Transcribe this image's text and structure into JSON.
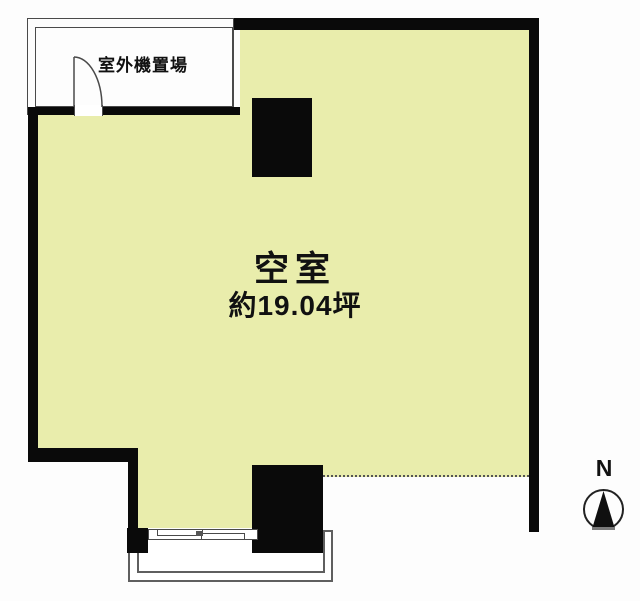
{
  "plan": {
    "outdoor_unit_label": "室外機置場",
    "room": {
      "status_label": "空室",
      "area_label": "約19.04坪"
    },
    "compass": {
      "north_label": "N"
    }
  },
  "colors": {
    "room_fill": "#e9edac",
    "wall": "#0a0a0a",
    "thin_line": "#4a4a4a",
    "porch_line": "#5f5f5f",
    "background": "#fdfdfd",
    "text": "#111111"
  }
}
